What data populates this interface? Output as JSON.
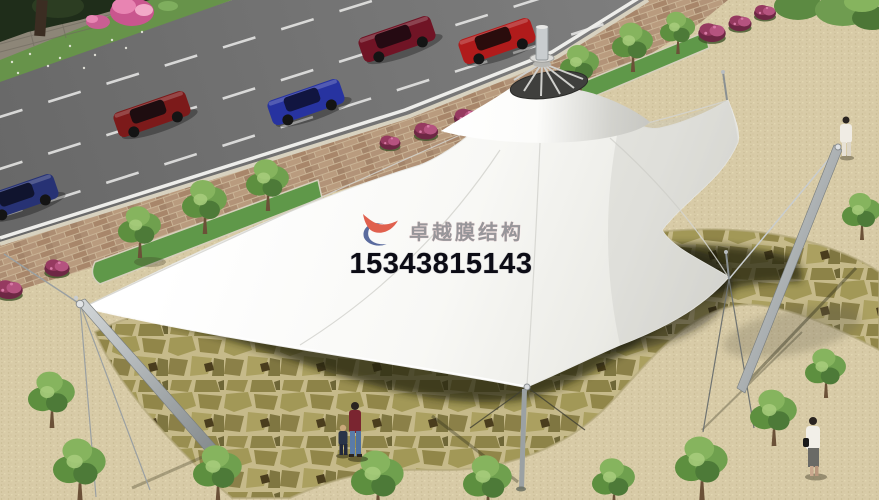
{
  "watermark": {
    "brand": "卓越膜结构",
    "phone": "15343815143",
    "brand_color": "#97969a",
    "phone_color": "#0c0c15",
    "logo_red": "#e0604e",
    "logo_blue": "#5a6b9e"
  },
  "palette": {
    "road": "#6f6f6f",
    "lane_marking": "#ececea",
    "sidewalk_brick": "#b2957a",
    "plaza_sand": "#d8cba7",
    "flagstone": "#9a9055",
    "flagstone_shadow": "#23220f",
    "membrane_white": "#fafaf7",
    "membrane_shade": "#dededa",
    "steel_mast": "#9ba1a3",
    "grass_strip": "#5f9849",
    "tree_green": "#6fa04e",
    "flower_bush": "#963a60",
    "car_red": "#b01b1b",
    "car_dark_red": "#7c1a1a",
    "car_maroon": "#701425",
    "car_blue": "#2733a0",
    "car_navy": "#273274"
  }
}
